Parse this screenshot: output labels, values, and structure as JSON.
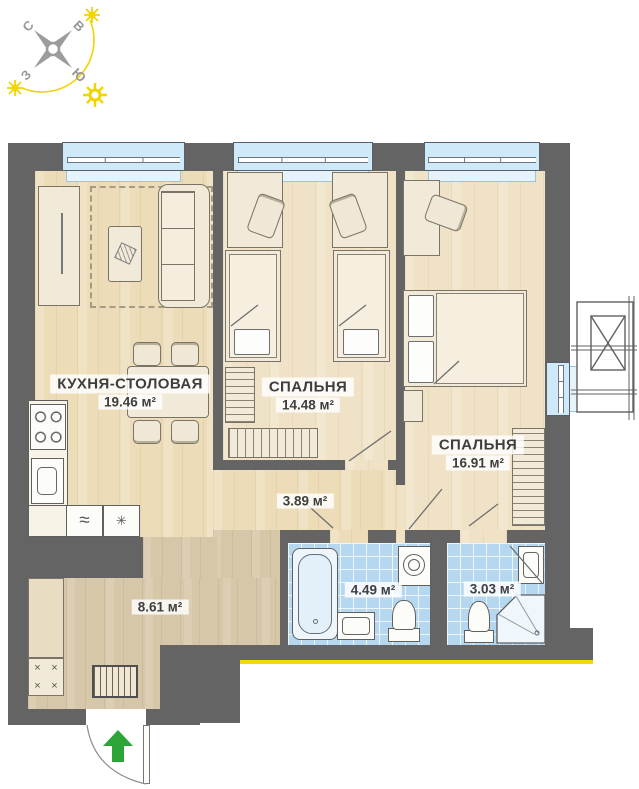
{
  "compass": {
    "letters": {
      "n": "С",
      "e": "В",
      "w": "З",
      "s": "Ю"
    }
  },
  "rooms": [
    {
      "name": "КУХНЯ-СТОЛОВАЯ",
      "area": "19.46 м²"
    },
    {
      "name": "СПАЛЬНЯ",
      "area": "14.48 м²"
    },
    {
      "name": "СПАЛЬНЯ",
      "area": "16.91 м²"
    },
    {
      "area": "3.89 м²"
    },
    {
      "area": "4.49 м²"
    },
    {
      "area": "3.03 м²"
    },
    {
      "area": "8.61 м²"
    }
  ],
  "icons": {
    "washing_machine": "≈",
    "extractor": "✳",
    "shoe_cabinet_cross": "×"
  },
  "colors": {
    "wall": "#646464",
    "floor_wood": "#ecdcb8",
    "floor_corridor": "#d6c7a9",
    "tile_blue": "#b5d7f0",
    "window_glass": "#cfe9f8",
    "sun_yellow": "#f2d500",
    "facade_yellow": "#f4d900",
    "entry_arrow_green": "#2ca437"
  }
}
